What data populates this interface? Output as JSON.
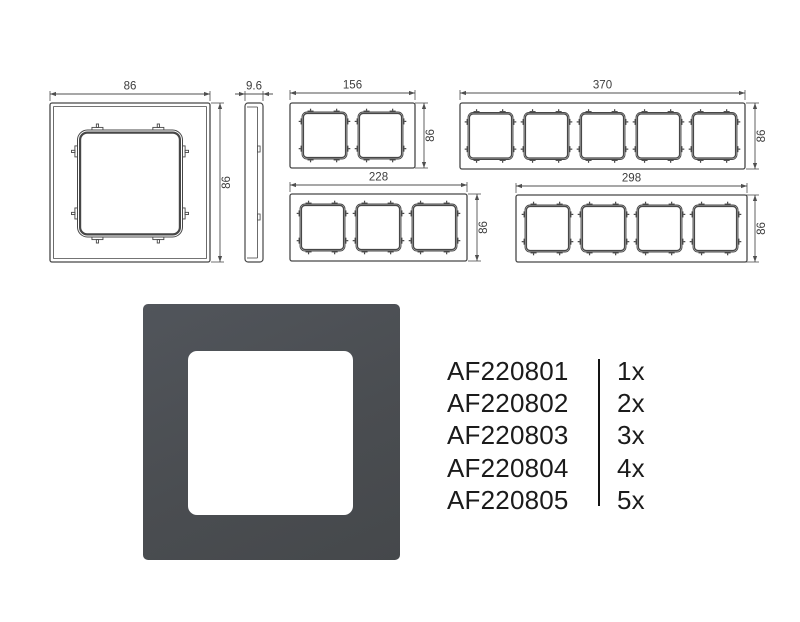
{
  "page": {
    "background": "#ffffff"
  },
  "drawings": {
    "line_color": "#474747",
    "dim_color": "#4f4f4f",
    "text_color": "#3c3c3c",
    "single_front": {
      "name": "1-gang frame front view",
      "width_label": "86",
      "height_label": "86"
    },
    "side_view": {
      "name": "frame side view",
      "thickness_label": "9.6"
    },
    "gang_frames": [
      {
        "name": "2-gang frame front view",
        "gangs": 2,
        "width_label": "156",
        "height_label": "86"
      },
      {
        "name": "5-gang frame front view",
        "gangs": 5,
        "width_label": "370",
        "height_label": "86"
      },
      {
        "name": "3-gang frame front view",
        "gangs": 3,
        "width_label": "228",
        "height_label": "86"
      },
      {
        "name": "4-gang frame front view",
        "gangs": 4,
        "width_label": "298",
        "height_label": "86"
      }
    ]
  },
  "product_photo": {
    "frame_color": "#4a4d51",
    "frame_gradient_light": "#51555b",
    "frame_gradient_dark": "#45484b",
    "window_color": "#ffffff"
  },
  "products": {
    "text_color": "#1b1b1b",
    "divider_color": "#141414",
    "rows": [
      {
        "code": "AF220801",
        "qty": "1x"
      },
      {
        "code": "AF220802",
        "qty": "2x"
      },
      {
        "code": "AF220803",
        "qty": "3x"
      },
      {
        "code": "AF220804",
        "qty": "4x"
      },
      {
        "code": "AF220805",
        "qty": "5x"
      }
    ]
  }
}
